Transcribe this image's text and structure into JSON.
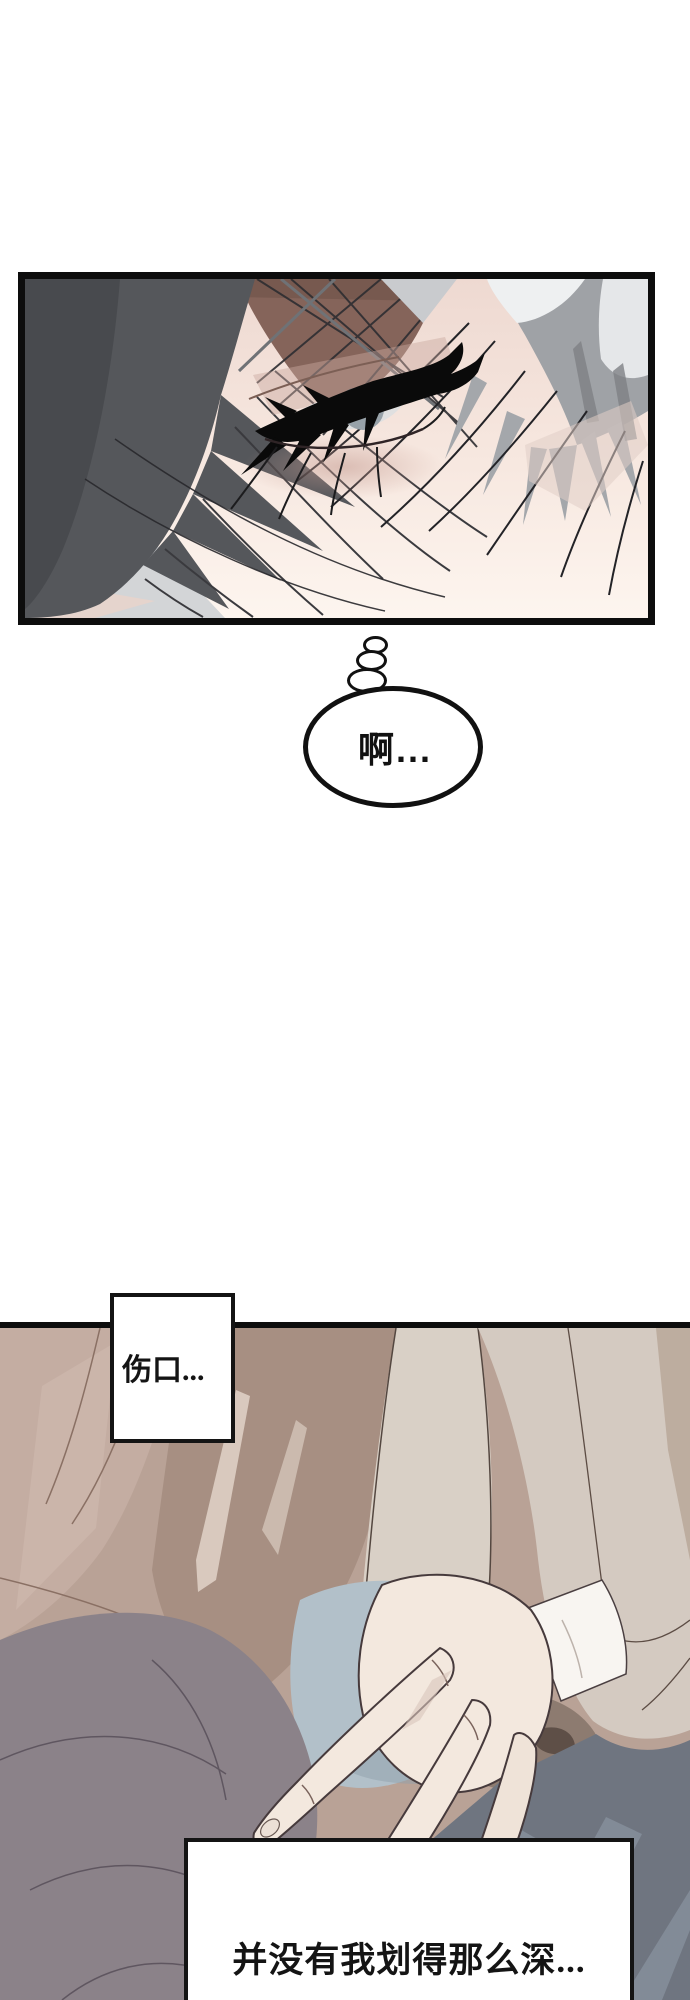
{
  "page": {
    "background": "#ffffff"
  },
  "thought_bubble": {
    "text": "啊..."
  },
  "caption_wound": {
    "text": "伤口..."
  },
  "caption_depth": {
    "text": "并没有我划得那么深..."
  },
  "colors": {
    "panel_border": "#0d0d0d",
    "bubble_outline": "#111111",
    "caption_border": "#141414",
    "hair_dark_gray": "#55575b",
    "hair_darker_gray": "#484a4e",
    "hair_light_gray": "#9fa2a6",
    "hair_highlight_white": "#eef0f1",
    "forehead_skin_shadow": "#85645a",
    "face_skin_light": "#fdf5ef",
    "under_eye_blush": "#c49a90",
    "iris_gray": "#98a2a9",
    "clothing_beige": "#b9a296",
    "clothing_pink_beige": "#c4ada2",
    "clothing_taupe": "#a78f82",
    "clothing_cream_strip": "#d9d0c6",
    "shoulder_beige": "#d4cac1",
    "fabric_gray": "#8b8289",
    "fabric_slate_blue": "#6f7580",
    "fabric_blue_gray": "#b2c0c9",
    "hand_skin": "#f3e8de",
    "bandage_white": "#f8f5f1",
    "line_art": "#463a3c"
  }
}
